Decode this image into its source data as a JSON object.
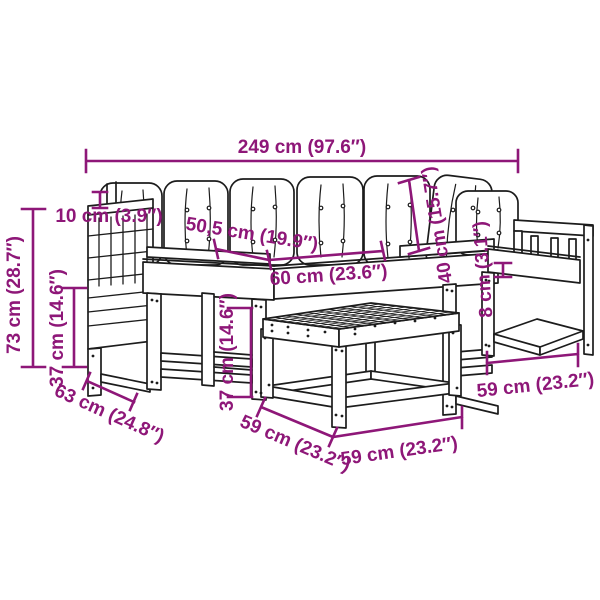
{
  "diagram": {
    "background_color": "#ffffff",
    "annotation_color": "#8E1778",
    "line_art_color": "#1c1c1c",
    "illustration": "garden-sofa-set-with-coffee-table-line-drawing",
    "labels": {
      "overall_width": "249 cm (97.6″)",
      "overall_height": "73 cm (28.7″)",
      "seat_height": "37 cm (14.6″)",
      "back_cushion_thickness": "10 cm (3.9″)",
      "seat_depth": "50,5 cm (19.9″)",
      "seat_width": "60 cm (23.6″)",
      "back_cushion_height": "40 cm (15.7″)",
      "seat_cushion_thickness": "8 cm (3.1″)",
      "chair_width": "59 cm (23.2″)",
      "section_depth": "63 cm (24.8″)",
      "table_height": "37 cm (14.6″)",
      "table_depth": "59 cm (23.2″)",
      "table_width": "59 cm (23.2″)"
    }
  }
}
